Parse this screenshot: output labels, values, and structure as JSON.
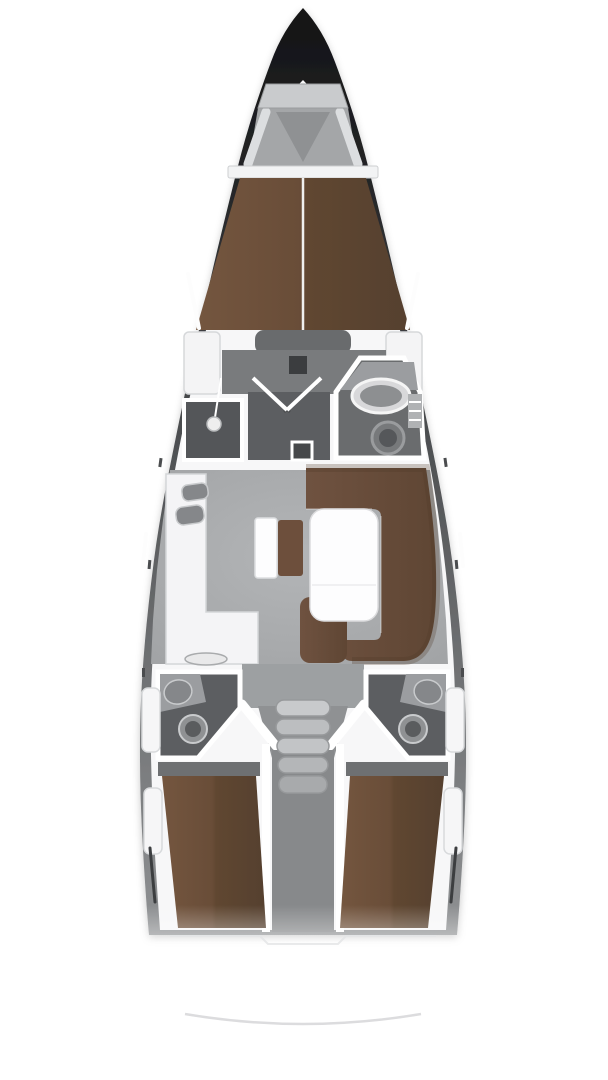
{
  "plan": {
    "type": "boat-floor-plan",
    "vessel": "sailing-yacht-interior-layout",
    "orientation": "bow-up",
    "sections": [
      {
        "name": "bow",
        "features": [
          "anchor-locker",
          "foredeck",
          "pulpit-struts"
        ]
      },
      {
        "name": "forward-cabin",
        "features": [
          "v-berth",
          "berth-center-seam",
          "foot-pad",
          "wardrobe-port",
          "wardrobe-starboard",
          "hull-window-port",
          "hull-window-starboard"
        ]
      },
      {
        "name": "forward-head",
        "features": [
          "shower-room",
          "shower-head",
          "door-swing",
          "mast-step",
          "floor-hatch",
          "washbasin",
          "round-fixture",
          "cabinet"
        ]
      },
      {
        "name": "salon",
        "features": [
          "galley-counter",
          "galley-sink-1",
          "galley-sink-2",
          "stove",
          "chart-table",
          "nav-seat",
          "u-shaped-sofa",
          "salon-table"
        ]
      },
      {
        "name": "aft",
        "features": [
          "aft-head-port",
          "aft-head-starboard",
          "washbasin-port",
          "washbasin-starboard",
          "toilet-port",
          "toilet-starboard",
          "companionway-stairs",
          "engine-compartment",
          "aft-cabin-port-berth",
          "aft-cabin-starboard-berth",
          "side-locker-port",
          "side-locker-starboard"
        ]
      },
      {
        "name": "stern",
        "features": [
          "transom-step",
          "swim-platform-edge"
        ]
      }
    ],
    "companionway": {
      "steps": 5
    }
  },
  "colors": {
    "background": "#ffffff",
    "hull_dark": "#141416",
    "hull_mid": "#4e5052",
    "hull_light": "#8a8c8e",
    "deck_white": "#f7f7f8",
    "locker_gray": "#c9cbcd",
    "foredeck_gray": "#a4a6a8",
    "berth_brown_light": "#74563f",
    "berth_brown_dark": "#55402f",
    "cabin_floor": "#797b7d",
    "compartment_floor": "#5c5e61",
    "salon_floor_light": "#b3b5b7",
    "salon_floor_dark": "#a0a2a4",
    "sofa_brown": "#6d4f3c",
    "sofa_brown_dark": "#5a4130",
    "engine_gray": "#87898b",
    "wall_white": "#ffffff",
    "hull_window_dark": "#3c3e40",
    "stern_line": "#dcdcde"
  }
}
